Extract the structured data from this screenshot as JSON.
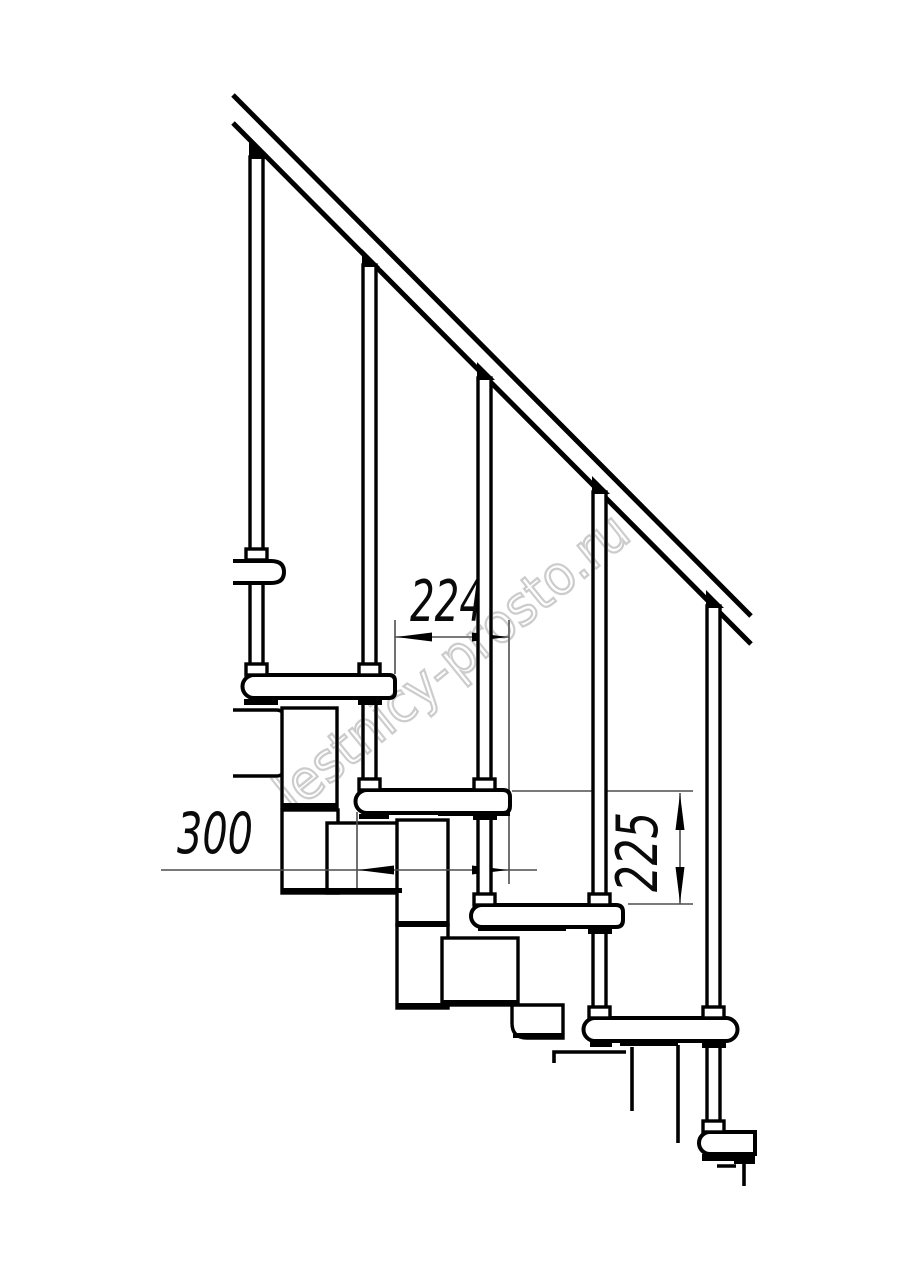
{
  "drawing": {
    "dimensions": {
      "step_run": {
        "label": "224"
      },
      "tread_depth": {
        "label": "300"
      },
      "step_rise": {
        "label": "225"
      }
    },
    "watermark": {
      "text": "lestnicy-prosto.ru"
    },
    "colors": {
      "line": "#000000",
      "dimension_line": "#4d4d4d",
      "watermark": "#c7c7c7",
      "background": "#ffffff"
    }
  }
}
